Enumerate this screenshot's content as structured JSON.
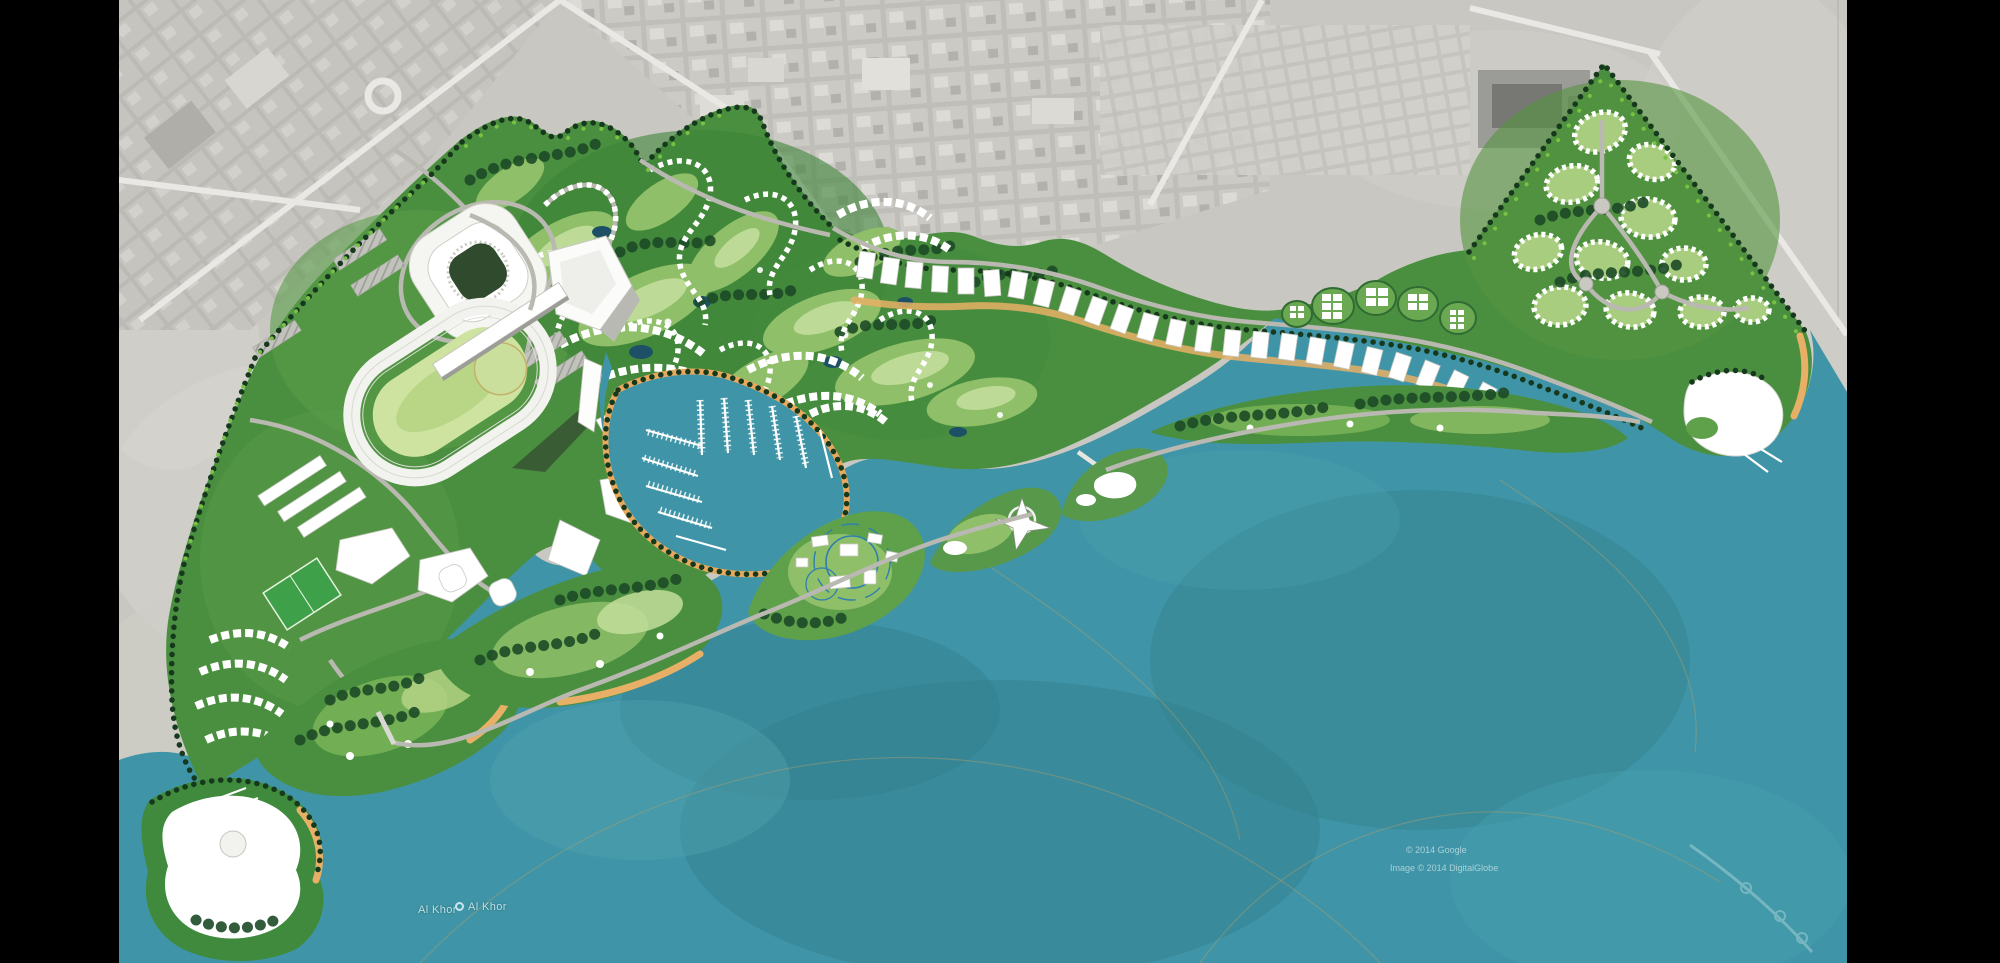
{
  "viewer": {
    "background_color": "#000000"
  },
  "map": {
    "description": "Aerial masterplan rendering of a coastal resort development over satellite imagery",
    "labels": {
      "place_primary": "Al Khor",
      "place_secondary": "Al Khor"
    },
    "credits": {
      "line1": "© 2014 Google",
      "line2": "Image © 2014 DigitalGlobe"
    },
    "palette": {
      "letterbox": "#000000",
      "water": "#3f95a7",
      "water_deep": "#35818f",
      "water_shallow": "#5fa9b5",
      "desert": "#c9c7c1",
      "city_block": "#b7b5b0",
      "street": "#e9e8e4",
      "parkland": "#4a8f3f",
      "fairway": "#9cc873",
      "fairway_light": "#cfe3a2",
      "forest": "#1d4a27",
      "tree_lime": "#79c143",
      "beach_sand": "#e7b066",
      "building_white": "#ffffff",
      "road_gray": "#b9b9b1",
      "pond_blue": "#1d5066"
    }
  }
}
